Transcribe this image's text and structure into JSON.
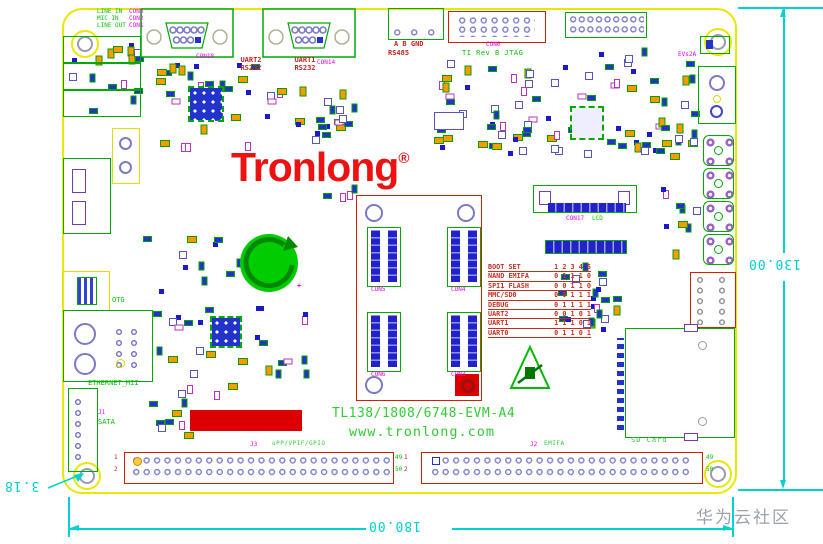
{
  "logo": {
    "text": "Tronlong",
    "reg": "®"
  },
  "board": {
    "name": "TL138/1808/6748-EVM-A4",
    "site": "www.tronlong.com",
    "rev": "EVs2A"
  },
  "audio": {
    "labels": [
      "LINE IN",
      "MIC IN",
      "LINE OUT"
    ],
    "refs": [
      "CON3",
      "CON2",
      "CON1"
    ]
  },
  "serial": {
    "uart2_line1": "UART2",
    "uart2_line2": "RS232",
    "uart1_line1": "UART1",
    "uart1_line2": "RS232",
    "ref_uart2": "CON18",
    "ref_uart1": "CON14"
  },
  "rs485": {
    "pins": "A  B  GND",
    "label": "RS485"
  },
  "jtag": {
    "label": "TI Rev B JTAG",
    "ref": "CON6"
  },
  "left_io": {
    "otg": "OTG",
    "eth": "ETHERNET_MII",
    "sata": "SATA",
    "sata_ref": "J1"
  },
  "lcd": {
    "ref": "CON17",
    "label": "LCD"
  },
  "core": {
    "refs": [
      "CON5",
      "CON4",
      "CON6",
      "CON3"
    ]
  },
  "battery": {
    "plus": "+"
  },
  "boot_table": {
    "title": "BOOT SET",
    "cols": "1 2 3 4 5",
    "rows": [
      {
        "label": "NAND EMIFA",
        "bits": "0 1 1 1 0"
      },
      {
        "label": "SPI1 FLASH",
        "bits": "0 0 1 1 0"
      },
      {
        "label": "MMC/SD0",
        "bits": "0 0 1 1 1"
      },
      {
        "label": "DEBUG",
        "bits": "0 1 1 1 1"
      },
      {
        "label": "UART2",
        "bits": "0 0 1 0 1"
      },
      {
        "label": "UART1",
        "bits": "1 1 1 0 1"
      },
      {
        "label": "UART0",
        "bits": "0 1 1 0 1"
      }
    ]
  },
  "headers": {
    "upp": {
      "ref": "J3",
      "label": "uPP/VPIF/GPIO"
    },
    "emifa": {
      "ref": "J2",
      "label": "EMIFA"
    },
    "pins": {
      "p1": "1",
      "p2": "2",
      "p49": "49",
      "p50": "50"
    }
  },
  "sd": {
    "label": "SD Card"
  },
  "dimensions": {
    "width": "180.00",
    "height": "130.00",
    "hole": "3.18"
  },
  "watermark": "华为云社区",
  "colors": {
    "board_outline": "#e8e800",
    "silk_green": "#00aa00",
    "text_green": "#00c400",
    "silk_red": "#cc2200",
    "logo_red": "#ee1111",
    "refdes_magenta": "#ee00ee",
    "pin_violet": "#8585cc",
    "dim_cyan": "#00d2d2"
  },
  "decor": {
    "zones": [
      {
        "x": 68,
        "y": 40,
        "w": 72,
        "h": 68,
        "n": 16
      },
      {
        "x": 150,
        "y": 62,
        "w": 106,
        "h": 82,
        "n": 26
      },
      {
        "x": 262,
        "y": 88,
        "w": 88,
        "h": 54,
        "n": 16
      },
      {
        "x": 300,
        "y": 102,
        "w": 52,
        "h": 42,
        "n": 8
      },
      {
        "x": 420,
        "y": 58,
        "w": 108,
        "h": 88,
        "n": 22
      },
      {
        "x": 545,
        "y": 44,
        "w": 118,
        "h": 112,
        "n": 30
      },
      {
        "x": 612,
        "y": 60,
        "w": 82,
        "h": 92,
        "n": 20
      },
      {
        "x": 652,
        "y": 124,
        "w": 42,
        "h": 134,
        "n": 12
      },
      {
        "x": 140,
        "y": 232,
        "w": 108,
        "h": 166,
        "n": 30
      },
      {
        "x": 255,
        "y": 300,
        "w": 58,
        "h": 78,
        "n": 12
      },
      {
        "x": 486,
        "y": 90,
        "w": 58,
        "h": 62,
        "n": 12
      },
      {
        "x": 547,
        "y": 257,
        "w": 66,
        "h": 66,
        "n": 14
      },
      {
        "x": 590,
        "y": 284,
        "w": 44,
        "h": 44,
        "n": 8
      },
      {
        "x": 322,
        "y": 180,
        "w": 28,
        "h": 20,
        "n": 4
      },
      {
        "x": 432,
        "y": 108,
        "w": 58,
        "h": 38,
        "n": 8
      },
      {
        "x": 146,
        "y": 398,
        "w": 44,
        "h": 44,
        "n": 9
      }
    ]
  }
}
